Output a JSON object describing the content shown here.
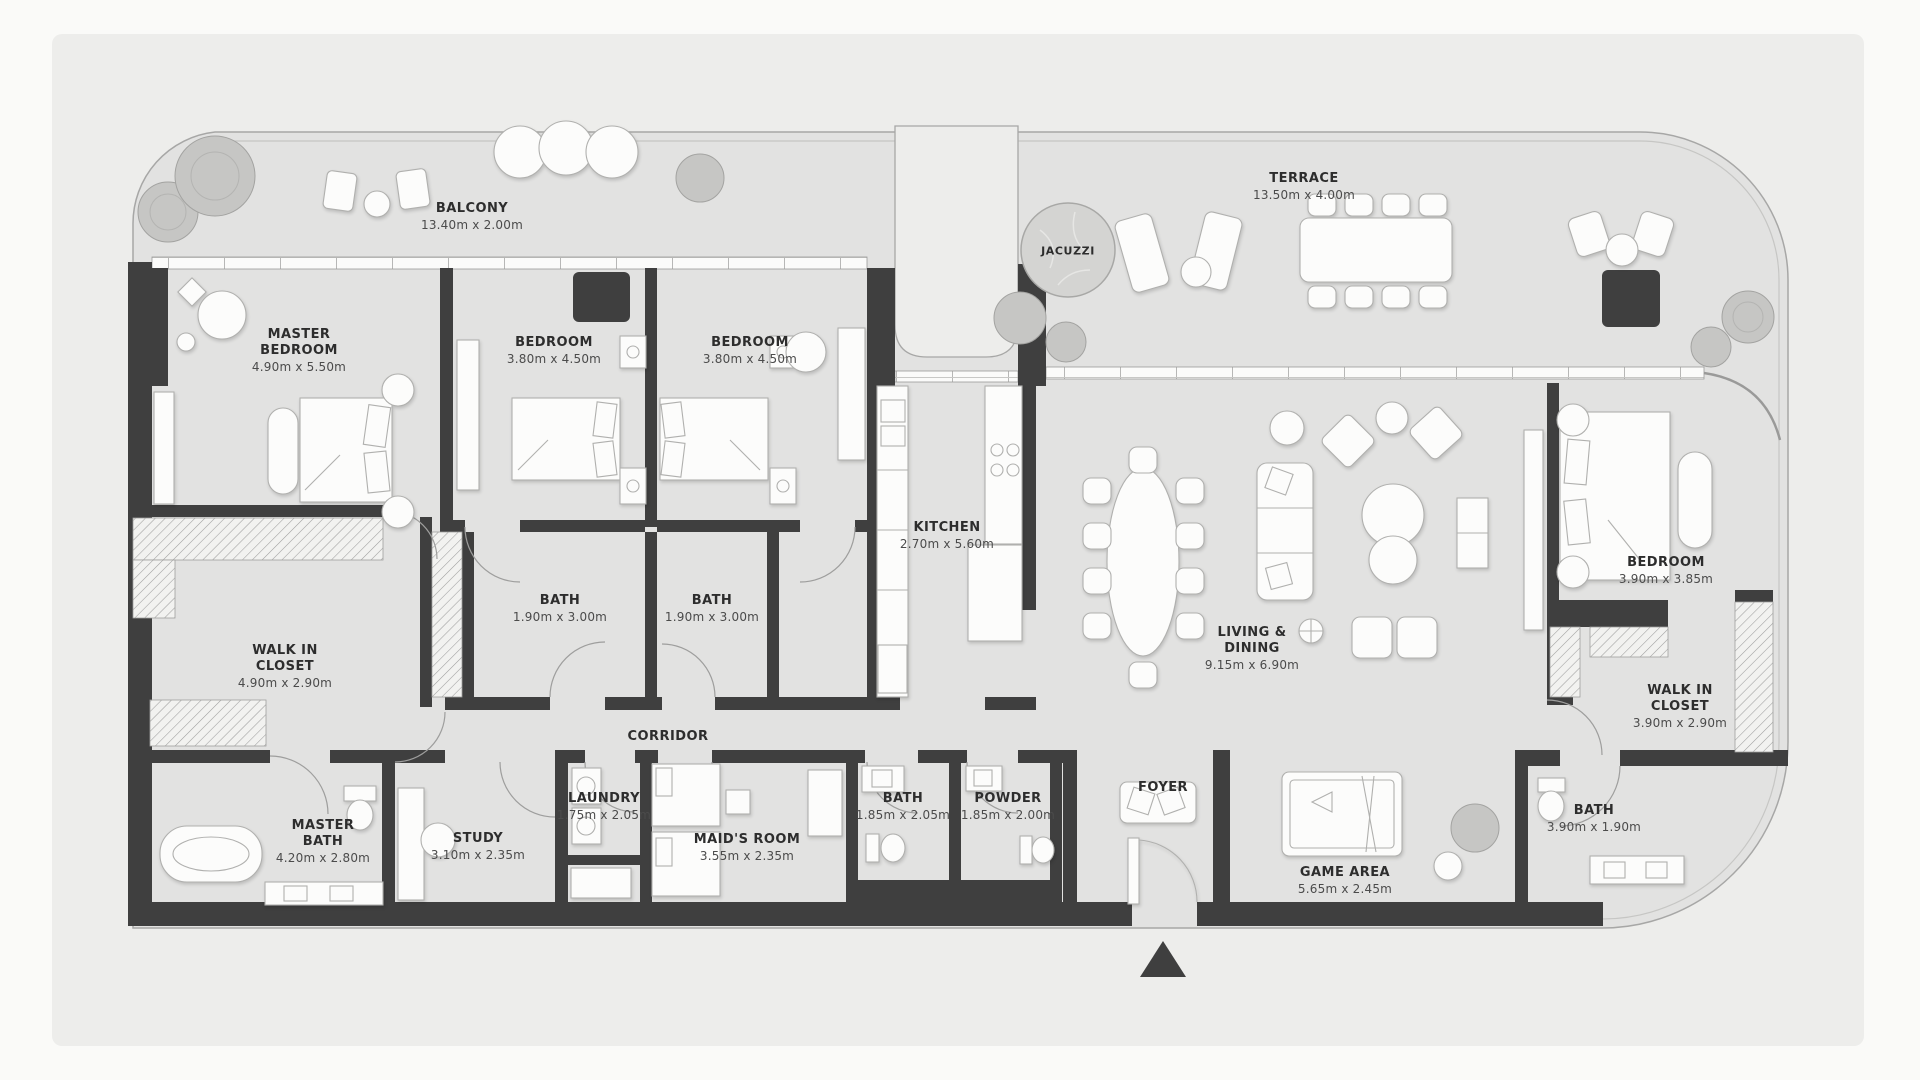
{
  "plan": {
    "type": "apartment-floor-plan",
    "colors": {
      "page_background": "#fafaf8",
      "panel_background": "#ededeb",
      "floor": "#e2e2e1",
      "walls": "#3f3f3f",
      "furniture": "#fcfcfb",
      "label_text": "#2d2d2d",
      "dims_text": "#4b4b4b"
    },
    "rooms": [
      {
        "id": "balcony",
        "name": "BALCONY",
        "dims": "13.40m x 2.00m"
      },
      {
        "id": "terrace",
        "name": "TERRACE",
        "dims": "13.50m x 4.00m"
      },
      {
        "id": "jacuzzi",
        "name": "JACUZZI",
        "dims": ""
      },
      {
        "id": "master-bedroom",
        "name": "MASTER BEDROOM",
        "dims": "4.90m x 5.50m"
      },
      {
        "id": "bedroom-2",
        "name": "BEDROOM",
        "dims": "3.80m x 4.50m"
      },
      {
        "id": "bedroom-3",
        "name": "BEDROOM",
        "dims": "3.80m x 4.50m"
      },
      {
        "id": "kitchen",
        "name": "KITCHEN",
        "dims": "2.70m x 5.60m"
      },
      {
        "id": "living-dining",
        "name": "LIVING & DINING",
        "dims": "9.15m x 6.90m"
      },
      {
        "id": "bedroom-4",
        "name": "BEDROOM",
        "dims": "3.90m x 3.85m"
      },
      {
        "id": "walk-in-closet-left",
        "name": "WALK IN CLOSET",
        "dims": "4.90m x 2.90m"
      },
      {
        "id": "bath-1",
        "name": "BATH",
        "dims": "1.90m x 3.00m"
      },
      {
        "id": "bath-2",
        "name": "BATH",
        "dims": "1.90m x 3.00m"
      },
      {
        "id": "corridor",
        "name": "CORRIDOR",
        "dims": ""
      },
      {
        "id": "master-bath",
        "name": "MASTER BATH",
        "dims": "4.20m x 2.80m"
      },
      {
        "id": "study",
        "name": "STUDY",
        "dims": "3.10m x 2.35m"
      },
      {
        "id": "laundry",
        "name": "LAUNDRY",
        "dims": "1.75m x 2.05m"
      },
      {
        "id": "maids-room",
        "name": "MAID'S ROOM",
        "dims": "3.55m x 2.35m"
      },
      {
        "id": "bath-3",
        "name": "BATH",
        "dims": "1.85m x 2.05m"
      },
      {
        "id": "powder",
        "name": "POWDER",
        "dims": "1.85m x 2.00m"
      },
      {
        "id": "foyer",
        "name": "FOYER",
        "dims": ""
      },
      {
        "id": "game-area",
        "name": "GAME AREA",
        "dims": "5.65m x 2.45m"
      },
      {
        "id": "walk-in-closet-right",
        "name": "WALK IN CLOSET",
        "dims": "3.90m x 2.90m"
      },
      {
        "id": "bath-4",
        "name": "BATH",
        "dims": "3.90m x 1.90m"
      }
    ]
  }
}
